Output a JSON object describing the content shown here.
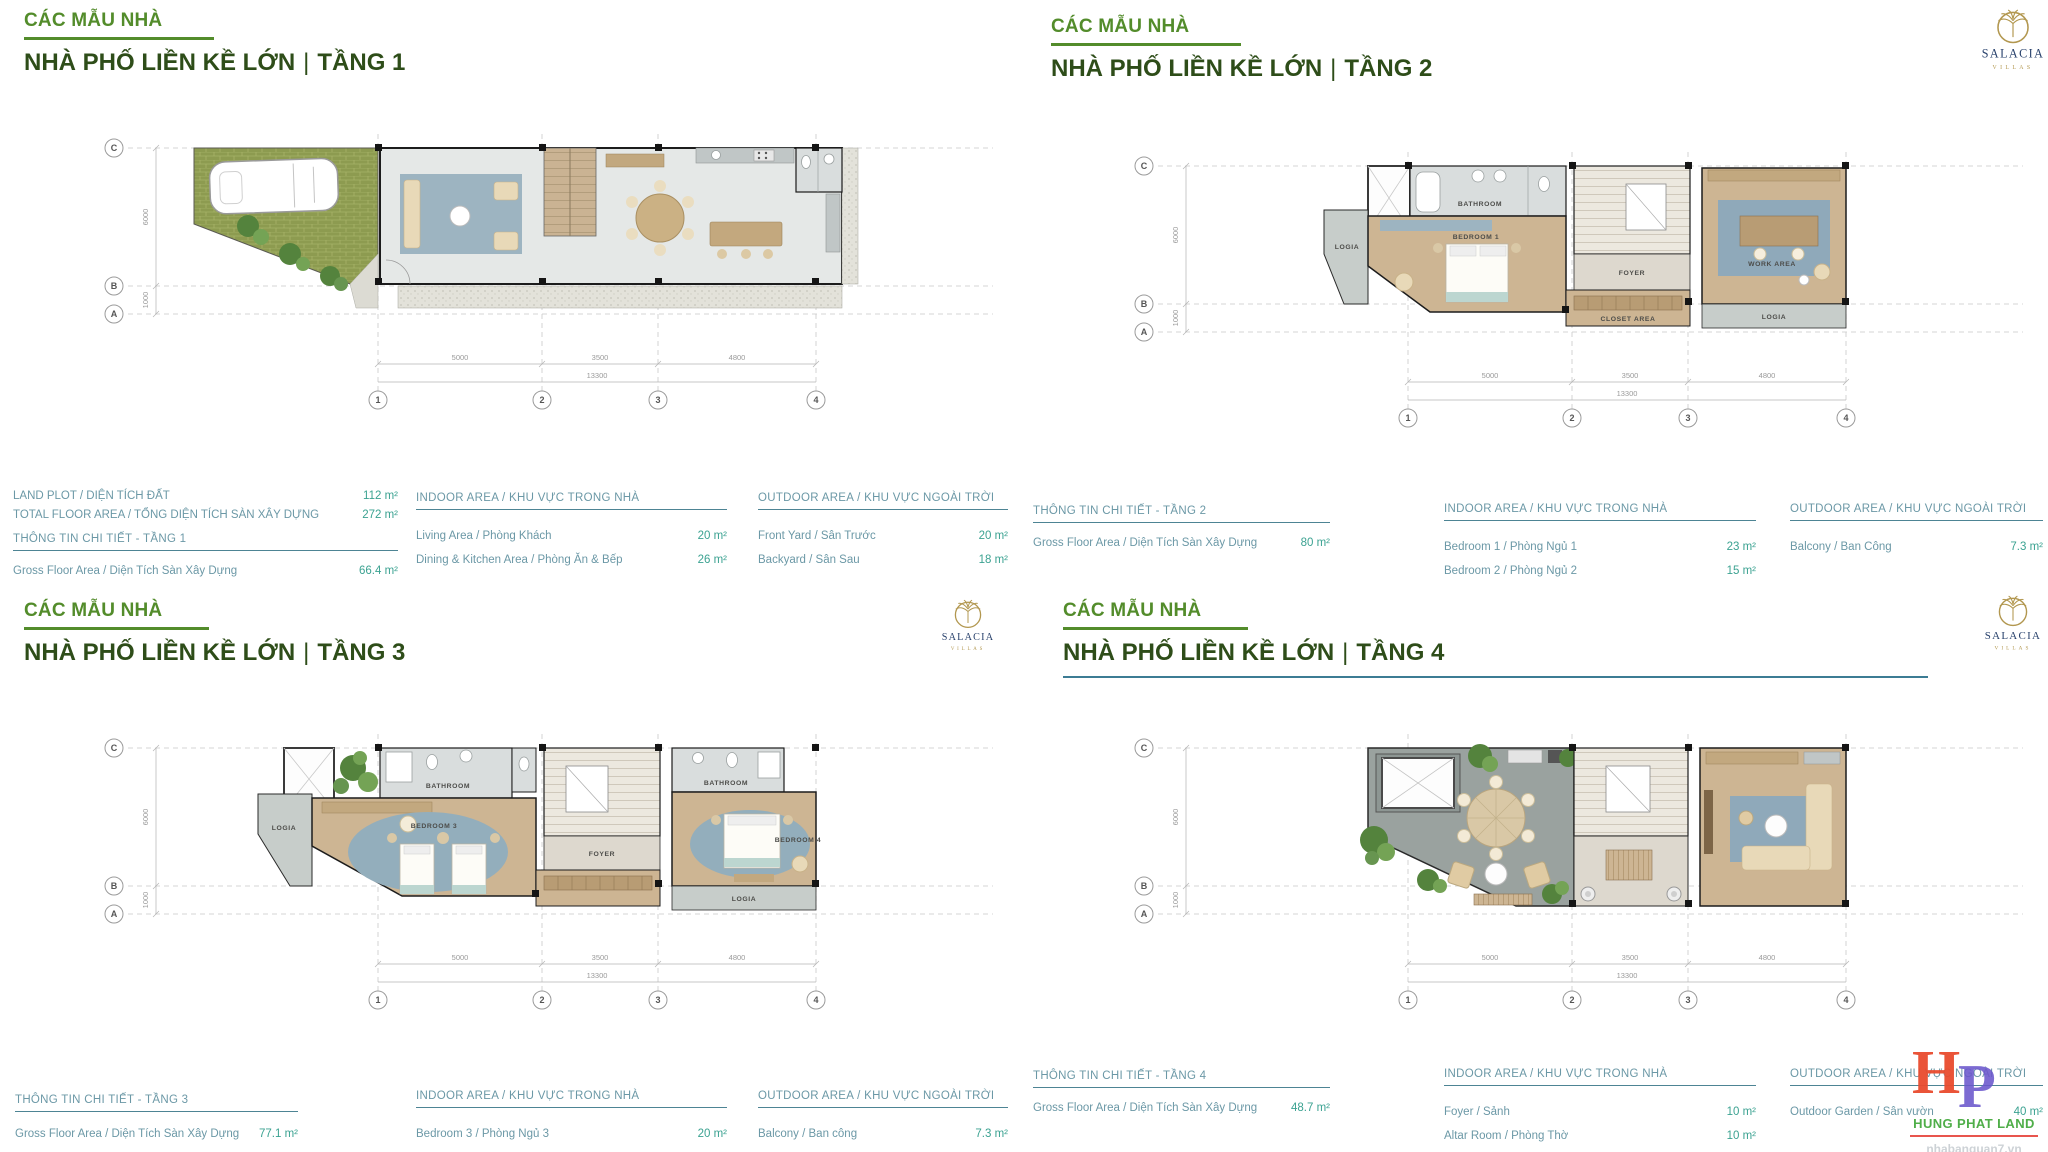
{
  "page": {
    "background": "#ffffff"
  },
  "branding": {
    "salacia": {
      "name": "SALACIA",
      "subtitle": "VILLAS",
      "gold": "#b2974f",
      "navy": "#27406b"
    },
    "watermark": {
      "letter_h": "H",
      "letter_p": "P",
      "company": "HUNG PHAT LAND",
      "website": "nhabanquan7.vn",
      "phone": "0918.089.169",
      "h_color": "#e94b2e",
      "p_color": "#6b57cc",
      "company_color": "#4fae49"
    }
  },
  "plans": {
    "grid": {
      "rows": [
        "C",
        "B",
        "A"
      ],
      "cols": [
        "1",
        "2",
        "3",
        "4"
      ],
      "col_dims": [
        "5000",
        "3500",
        "4800"
      ],
      "total_dim": "13300",
      "row_dims": [
        "6000",
        "1000"
      ]
    },
    "floor2_rooms": {
      "logia_left": "LOGIA",
      "bathroom": "BATHROOM",
      "bedroom": "BEDROOM 1",
      "foyer": "FOYER",
      "closet": "CLOSET AREA",
      "work": "WORK AREA",
      "logia_right": "LOGIA"
    },
    "floor3_rooms": {
      "logia_left": "LOGIA",
      "bathroom_left": "BATHROOM",
      "bedroom_left": "BEDROOM 3",
      "foyer": "FOYER",
      "bathroom_right": "BATHROOM",
      "bedroom_right": "BEDROOM 4",
      "logia_right": "LOGIA"
    }
  },
  "quadrants": [
    {
      "eyebrow": "CÁC MẪU NHÀ",
      "title": "NHÀ PHỐ LIỀN KỀ LỚN",
      "sep": "|",
      "floor_label": "TẦNG 1",
      "info": {
        "land": {
          "label": "LAND PLOT / DIỆN TÍCH ĐẤT",
          "value": "112 m²"
        },
        "total": {
          "label": "TOTAL FLOOR AREA / TỔNG DIỆN TÍCH SÀN XÂY DỰNG",
          "value": "272 m²"
        },
        "detail_header": "THÔNG TIN CHI TIẾT - TẦNG 1",
        "gross": {
          "label": "Gross Floor Area / Diện Tích Sàn Xây Dựng",
          "value": "66.4 m²"
        },
        "indoor": {
          "header": "INDOOR AREA / KHU VỰC TRONG NHÀ",
          "rows": [
            {
              "label": "Living Area / Phòng Khách",
              "value": "20 m²"
            },
            {
              "label": "Dining & Kitchen Area / Phòng Ăn & Bếp",
              "value": "26 m²"
            }
          ]
        },
        "outdoor": {
          "header": "OUTDOOR AREA / KHU VỰC NGOÀI TRỜI",
          "rows": [
            {
              "label": "Front Yard / Sân Trước",
              "value": "20 m²"
            },
            {
              "label": "Backyard / Sân Sau",
              "value": "18 m²"
            }
          ]
        }
      }
    },
    {
      "eyebrow": "CÁC MẪU NHÀ",
      "title": "NHÀ PHỐ LIỀN KỀ LỚN",
      "sep": "|",
      "floor_label": "TẦNG 2",
      "info": {
        "detail_header": "THÔNG TIN CHI TIẾT - TẦNG 2",
        "gross": {
          "label": "Gross Floor Area / Diện Tích Sàn Xây Dựng",
          "value": "80 m²"
        },
        "indoor": {
          "header": "INDOOR AREA / KHU VỰC TRONG NHÀ",
          "rows": [
            {
              "label": "Bedroom 1 / Phòng Ngủ 1",
              "value": "23 m²"
            },
            {
              "label": "Bedroom 2 / Phòng Ngủ 2",
              "value": "15 m²"
            }
          ]
        },
        "outdoor": {
          "header": "OUTDOOR AREA / KHU VỰC NGOÀI TRỜI",
          "rows": [
            {
              "label": "Balcony / Ban Công",
              "value": "7.3 m²"
            }
          ]
        }
      }
    },
    {
      "eyebrow": "CÁC MẪU NHÀ",
      "title": "NHÀ PHỐ LIỀN KỀ LỚN",
      "sep": "|",
      "floor_label": "TẦNG 3",
      "info": {
        "detail_header": "THÔNG TIN CHI TIẾT - TẦNG 3",
        "gross": {
          "label": "Gross Floor Area / Diện Tích Sàn Xây Dựng",
          "value": "77.1 m²"
        },
        "indoor": {
          "header": "INDOOR AREA / KHU VỰC TRONG NHÀ",
          "rows": [
            {
              "label": "Bedroom 3 / Phòng Ngủ 3",
              "value": "20 m²"
            },
            {
              "label": "Bedroom 4 / Phòng Ngủ 4",
              "value": "15 m²"
            }
          ]
        },
        "outdoor": {
          "header": "OUTDOOR AREA / KHU VỰC NGOÀI TRỜI",
          "rows": [
            {
              "label": "Balcony / Ban công",
              "value": "7.3 m²"
            },
            {
              "label": "Garden / Sân Vườn",
              "value": "3 m²"
            }
          ]
        }
      }
    },
    {
      "eyebrow": "CÁC MẪU NHÀ",
      "title": "NHÀ PHỐ LIỀN KỀ LỚN",
      "sep": "|",
      "floor_label": "TẦNG 4",
      "info": {
        "detail_header": "THÔNG TIN CHI TIẾT - TẦNG 4",
        "gross": {
          "label": "Gross Floor Area / Diện Tích Sàn Xây Dựng",
          "value": "48.7 m²"
        },
        "indoor": {
          "header": "INDOOR AREA / KHU VỰC TRONG NHÀ",
          "rows": [
            {
              "label": "Foyer / Sảnh",
              "value": "10 m²"
            },
            {
              "label": "Altar Room / Phòng Thờ",
              "value": "10 m²"
            }
          ]
        },
        "outdoor": {
          "header": "OUTDOOR AREA / KHU VỰC NGOÀI TRỜI",
          "rows": [
            {
              "label": "Outdoor Garden / Sân vườn",
              "value": "40 m²"
            }
          ]
        }
      }
    }
  ]
}
